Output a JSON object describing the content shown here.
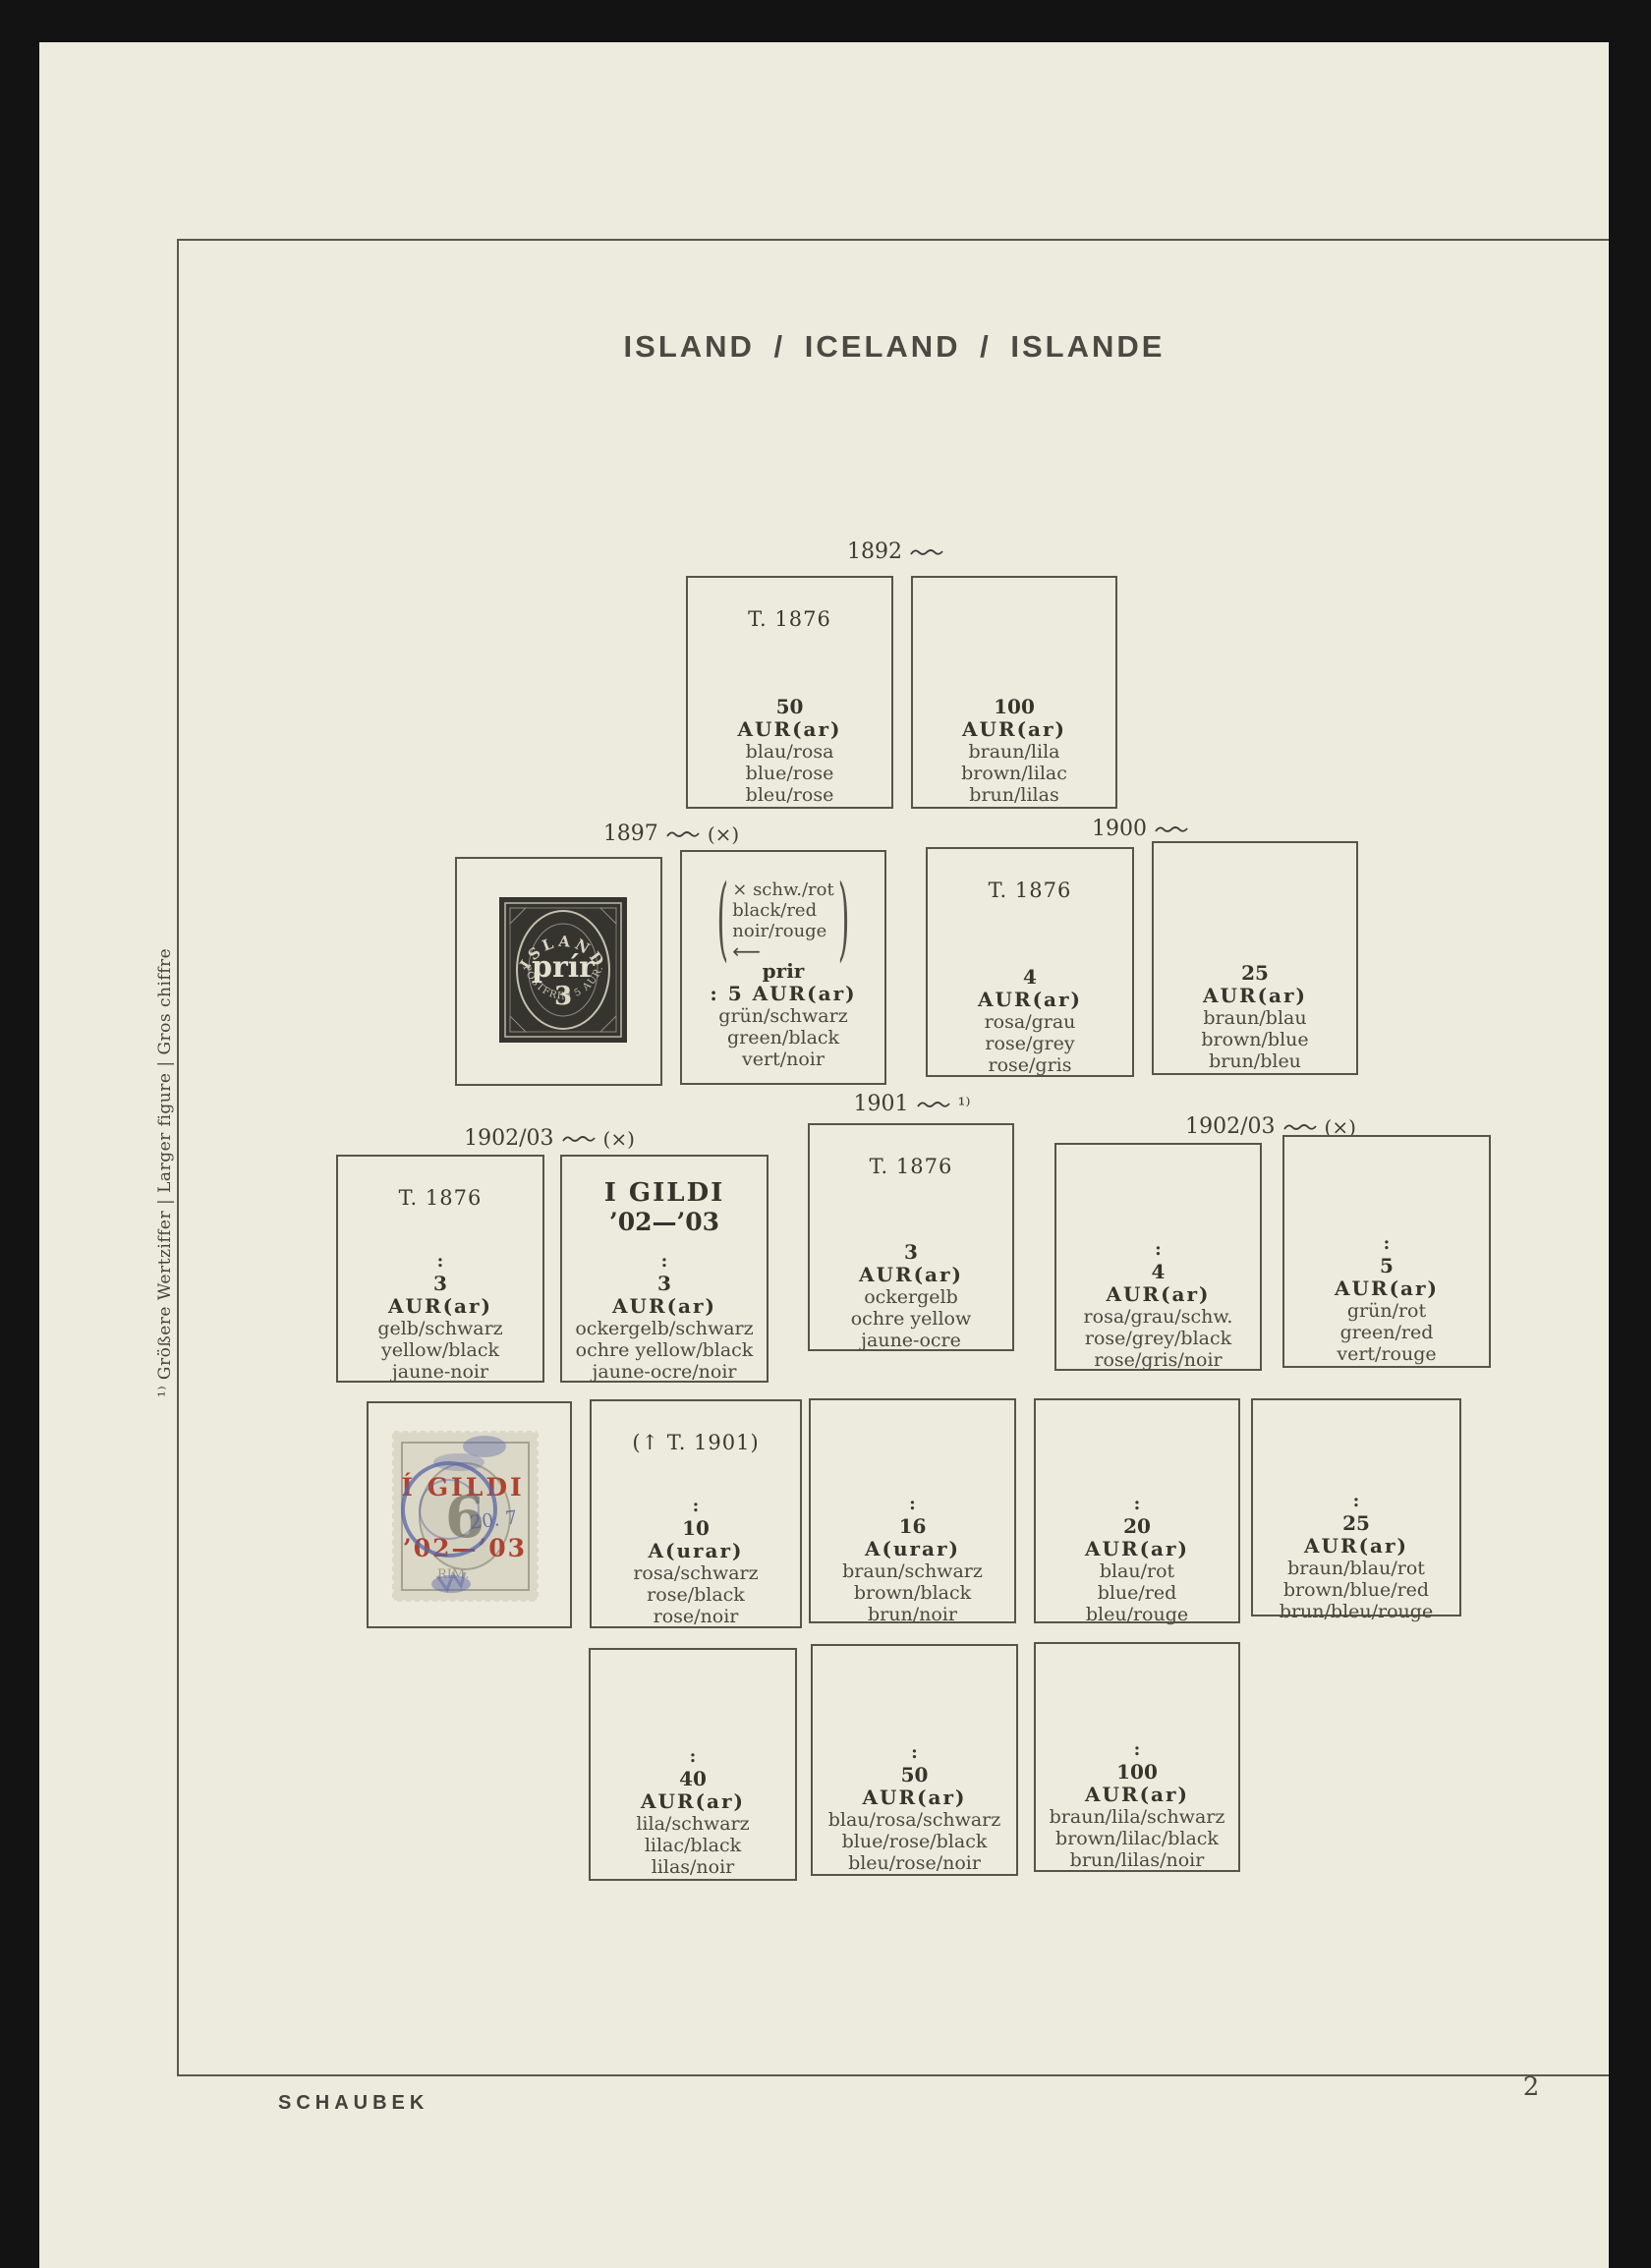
{
  "page": {
    "title": "ISLAND / ICELAND / ISLANDE",
    "margin_note": "¹⁾ Größere Wertziffer | Larger figure | Gros chiffre",
    "publisher": "SCHAUBEK",
    "page_number": "2"
  },
  "headers": {
    "y1892": {
      "year": "1892",
      "suffix": ""
    },
    "y1897": {
      "year": "1897",
      "suffix": "(×)"
    },
    "y1900": {
      "year": "1900",
      "suffix": ""
    },
    "y1902l": {
      "year": "1902/03",
      "suffix": "(×)"
    },
    "y1901": {
      "year": "1901",
      "suffix": "¹⁾"
    },
    "y1902r": {
      "year": "1902/03",
      "suffix": "(×)"
    }
  },
  "boxes": {
    "a": {
      "note": "T. 1876",
      "value": "50",
      "unit": "AUR(ar)",
      "c1": "blau/rosa",
      "c2": "blue/rose",
      "c3": "bleu/rose"
    },
    "b": {
      "value": "100",
      "unit": "AUR(ar)",
      "c1": "braun/lila",
      "c2": "brown/lilac",
      "c3": "brun/lilas"
    },
    "e": {
      "note": "T. 1876",
      "value": "4",
      "unit": "AUR(ar)",
      "c1": "rosa/grau",
      "c2": "rose/grey",
      "c3": "rose/gris"
    },
    "f": {
      "value": "25",
      "unit": "AUR(ar)",
      "c1": "braun/blau",
      "c2": "brown/blue",
      "c3": "brun/bleu"
    },
    "g": {
      "note": "T. 1876",
      "dots": ":",
      "value": "3",
      "unit": "AUR(ar)",
      "c1": "gelb/schwarz",
      "c2": "yellow/black",
      "c3": "jaune-noir"
    },
    "h": {
      "note1": "I GILDI",
      "note2": "’02—’03",
      "dots": ":",
      "value": "3",
      "unit": "AUR(ar)",
      "c1": "ockergelb/schwarz",
      "c2": "ochre yellow/black",
      "c3": "jaune-ocre/noir"
    },
    "i": {
      "note": "T. 1876",
      "value": "3",
      "unit": "AUR(ar)",
      "c1": "ockergelb",
      "c2": "ochre yellow",
      "c3": "jaune-ocre"
    },
    "j": {
      "dots": ":",
      "value": "4",
      "unit": "AUR(ar)",
      "c1": "rosa/grau/schw.",
      "c2": "rose/grey/black",
      "c3": "rose/gris/noir"
    },
    "k": {
      "dots": ":",
      "value": "5",
      "unit": "AUR(ar)",
      "c1": "grün/rot",
      "c2": "green/red",
      "c3": "vert/rouge"
    },
    "m": {
      "note": "(↑ T. 1901)",
      "dots": ":",
      "value": "10",
      "unit": "A(urar)",
      "c1": "rosa/schwarz",
      "c2": "rose/black",
      "c3": "rose/noir"
    },
    "n": {
      "dots": ":",
      "value": "16",
      "unit": "A(urar)",
      "c1": "braun/schwarz",
      "c2": "brown/black",
      "c3": "brun/noir"
    },
    "o": {
      "dots": ":",
      "value": "20",
      "unit": "AUR(ar)",
      "c1": "blau/rot",
      "c2": "blue/red",
      "c3": "bleu/rouge"
    },
    "p": {
      "dots": ":",
      "value": "25",
      "unit": "AUR(ar)",
      "c1": "braun/blau/rot",
      "c2": "brown/blue/red",
      "c3": "brun/bleu/rouge"
    },
    "q": {
      "dots": ":",
      "value": "40",
      "unit": "AUR(ar)",
      "c1": "lila/schwarz",
      "c2": "lilac/black",
      "c3": "lilas/noir"
    },
    "r": {
      "dots": ":",
      "value": "50",
      "unit": "AUR(ar)",
      "c1": "blau/rosa/schwarz",
      "c2": "blue/rose/black",
      "c3": "bleu/rose/noir"
    },
    "s": {
      "dots": ":",
      "value": "100",
      "unit": "AUR(ar)",
      "c1": "braun/lila/schwarz",
      "c2": "brown/lilac/black",
      "c3": "brun/lilas/noir"
    }
  },
  "annotation1897": {
    "open": "(",
    "close": ")",
    "line1": "× schw./rot",
    "line2": "black/red",
    "line3": "noir/rouge",
    "arrow": "⟵",
    "prir": "prir",
    "value_line": ": 5 AUR(ar)",
    "c1": "grün/schwarz",
    "c2": "green/black",
    "c3": "vert/noir"
  },
  "stamps": {
    "prir3": {
      "country": "ISLAND",
      "center": "prír",
      "numeral": "3",
      "bottom": "POSTFRIM 5 AUR."
    },
    "gildi6": {
      "numeral": "6",
      "overprint1": "Í GILDI",
      "overprint2": "’02—’03",
      "cancel_day": "20. 7",
      "rim_text": "RIM."
    }
  },
  "colors": {
    "page": "#ecebde",
    "surround": "#131313",
    "red_overprint": "#ad4330",
    "blue_cancel": "#5a66a3",
    "stamp_black": "#35342f"
  }
}
